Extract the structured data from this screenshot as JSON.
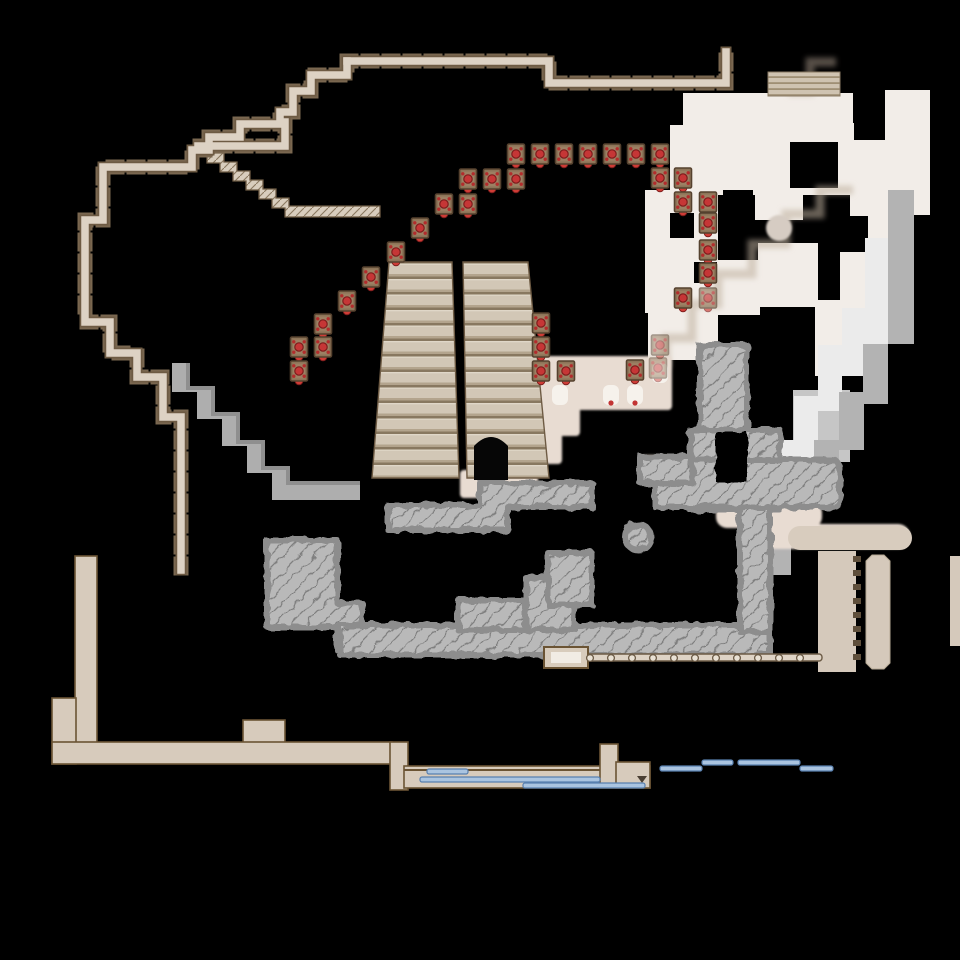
{
  "app": {
    "name": "dungeon-battle-map",
    "description": "Hand-drawn virtual-tabletop battle map: amphitheater with twin grand staircases, arcs of red chair tokens, crenellated stone walls, hatched cliff rubble, stepped gray paths, fog-revealed rooms and water channels on a black background",
    "visible_text": []
  },
  "palette": {
    "background": "#000000",
    "wall_fill": "#ddd2c4",
    "wall_outline": "#6e5b44",
    "wall_tick": "#7a6750",
    "platform_tan": "#d7cbbc",
    "platform_outline": "#6b5434",
    "stairs_light": "#d2c7b6",
    "stairs_shadow": "#887860",
    "chair_base": "#8d7458",
    "chair_red": "#c63636",
    "cliff_gray": "#b9b9b9",
    "cliff_edge": "#8d8d8d",
    "path_gray": "#b3b3b3",
    "path_white": "#ebebeb",
    "fog_white": "#f2ede8",
    "floor_pink": "#e8dcd2",
    "water_fill": "#aac4e0",
    "water_edge": "#587fae",
    "solid_gray_band": "#aeaeae"
  },
  "map": {
    "features": [
      {
        "name": "northwest-crenellated-wall",
        "type": "stone-wall"
      },
      {
        "name": "north-crenellated-wall",
        "type": "stone-wall"
      },
      {
        "name": "diagonal-hatched-stair",
        "type": "ramp"
      },
      {
        "name": "grand-staircase-left-flight",
        "type": "stairs"
      },
      {
        "name": "grand-staircase-right-flight",
        "type": "stairs"
      },
      {
        "name": "staircase-arch-doorway",
        "type": "doorway"
      },
      {
        "name": "mini-stairs-northeast",
        "type": "stairs"
      },
      {
        "name": "gray-stepped-walkway",
        "type": "walkway"
      },
      {
        "name": "cliff-rubble-south",
        "type": "cliff"
      },
      {
        "name": "cliff-rubble-ring-east",
        "type": "cliff"
      },
      {
        "name": "fog-revealed-rooms-east",
        "type": "revealed-floor"
      },
      {
        "name": "stepped-road-white",
        "type": "road"
      },
      {
        "name": "stepped-road-gray",
        "type": "road"
      },
      {
        "name": "pink-floor-hall",
        "type": "floor"
      },
      {
        "name": "southern-platform-wall",
        "type": "thick-wall"
      },
      {
        "name": "water-channel-south",
        "type": "water"
      },
      {
        "name": "bead-fence-south",
        "type": "fence"
      },
      {
        "name": "toothed-wall-column-southeast",
        "type": "wall"
      },
      {
        "name": "round-end-bar-southeast",
        "type": "wall"
      }
    ]
  },
  "tokens": {
    "chair": {
      "count": 36,
      "base_color": "#8d7458",
      "cushion_color": "#c63636"
    },
    "chairs": [
      {
        "x": 516,
        "y": 154
      },
      {
        "x": 540,
        "y": 154
      },
      {
        "x": 564,
        "y": 154
      },
      {
        "x": 588,
        "y": 154
      },
      {
        "x": 612,
        "y": 154
      },
      {
        "x": 636,
        "y": 154
      },
      {
        "x": 660,
        "y": 154
      },
      {
        "x": 468,
        "y": 179
      },
      {
        "x": 492,
        "y": 179
      },
      {
        "x": 516,
        "y": 179
      },
      {
        "x": 444,
        "y": 204
      },
      {
        "x": 468,
        "y": 204
      },
      {
        "x": 420,
        "y": 228
      },
      {
        "x": 396,
        "y": 252
      },
      {
        "x": 371,
        "y": 277
      },
      {
        "x": 347,
        "y": 301
      },
      {
        "x": 323,
        "y": 324
      },
      {
        "x": 299,
        "y": 347
      },
      {
        "x": 323,
        "y": 347
      },
      {
        "x": 299,
        "y": 371
      },
      {
        "x": 660,
        "y": 178
      },
      {
        "x": 683,
        "y": 178
      },
      {
        "x": 683,
        "y": 202
      },
      {
        "x": 708,
        "y": 202
      },
      {
        "x": 708,
        "y": 223
      },
      {
        "x": 708,
        "y": 250
      },
      {
        "x": 708,
        "y": 273
      },
      {
        "x": 683,
        "y": 298
      },
      {
        "x": 708,
        "y": 298,
        "o": 0.65
      },
      {
        "x": 660,
        "y": 345,
        "o": 0.5
      },
      {
        "x": 541,
        "y": 323
      },
      {
        "x": 541,
        "y": 347
      },
      {
        "x": 541,
        "y": 371
      },
      {
        "x": 566,
        "y": 371
      },
      {
        "x": 635,
        "y": 370
      },
      {
        "x": 658,
        "y": 368,
        "o": 0.45
      }
    ]
  },
  "water": {
    "segments": [
      {
        "x": 427,
        "y": 769,
        "w": 41
      },
      {
        "x": 420,
        "y": 777,
        "w": 180
      },
      {
        "x": 523,
        "y": 783,
        "w": 122
      },
      {
        "x": 660,
        "y": 766,
        "w": 42
      },
      {
        "x": 702,
        "y": 760,
        "w": 31
      },
      {
        "x": 738,
        "y": 760,
        "w": 62
      },
      {
        "x": 800,
        "y": 766,
        "w": 33
      }
    ]
  },
  "fence": {
    "rail_y": 654,
    "bead_y": 658,
    "bead_xs": [
      590,
      611,
      632,
      653,
      674,
      695,
      716,
      737,
      758,
      779,
      800
    ]
  }
}
